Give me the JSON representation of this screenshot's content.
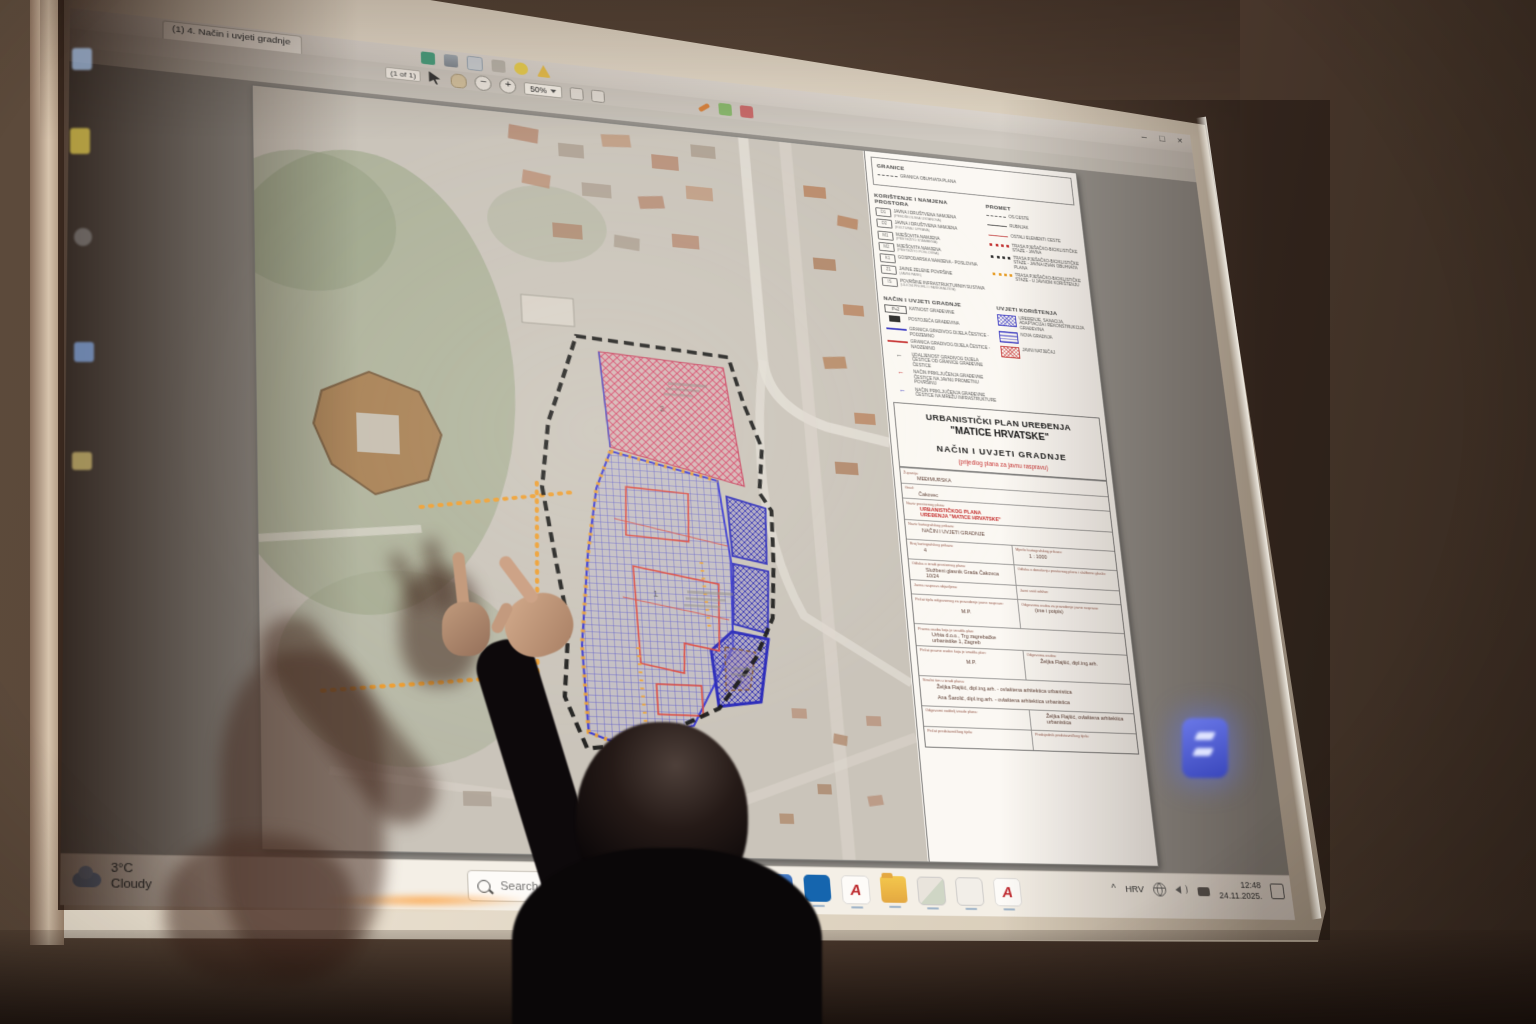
{
  "app": {
    "tab_title": "(1) 4. Način i uvjeti gradnje",
    "page_indicator": "(1 of 1)",
    "zoom_level": "50%",
    "zoom_out_glyph": "−",
    "zoom_in_glyph": "+",
    "customize_label": "Customize",
    "window_controls": [
      {
        "name": "minimize-button",
        "glyph": "–"
      },
      {
        "name": "maximize-button",
        "glyph": "□"
      },
      {
        "name": "close-button",
        "glyph": "×"
      }
    ],
    "panel_tabs": [
      {
        "name": "tab-tools",
        "label": "Tools"
      },
      {
        "name": "tab-fill-sign",
        "label": "Fill & Sign"
      },
      {
        "name": "tab-comment",
        "label": "Comment"
      }
    ],
    "toolbar_icons_row1": [
      {
        "name": "save-icon"
      },
      {
        "name": "print-icon"
      },
      {
        "name": "email-icon"
      },
      {
        "name": "attach-icon"
      },
      {
        "name": "comment-bubble-icon"
      },
      {
        "name": "warning-icon"
      }
    ],
    "toolbar_icons_row2b": [
      {
        "name": "pen-icon"
      },
      {
        "name": "stamp-green-icon"
      },
      {
        "name": "stamp-red-icon"
      }
    ],
    "sidebar_icon_names": [
      "thumbnails-icon",
      "signature-icon",
      "bookmarks-icon",
      "layers-icon",
      "attachments-icon"
    ]
  },
  "document": {
    "legend": {
      "granice_header": "GRANICE",
      "granice_item": "GRANICA OBUHVATA PLANA",
      "namjena_header": "KORIŠTENJE I NAMJENA PROSTORA",
      "namjena_items": [
        {
          "code": "D1",
          "label": "JAVNA I DRUŠTVENA NAMJENA",
          "sub": "(PREDŠKOLSKA USTANOVA)"
        },
        {
          "code": "D2",
          "label": "JAVNA I DRUŠTVENA NAMJENA",
          "sub": "(KULTURA I UPRAVA)"
        },
        {
          "code": "M1",
          "label": "MJEŠOVITA NAMJENA",
          "sub": "(PRETEŽITO STAMBENA)"
        },
        {
          "code": "M2",
          "label": "MJEŠOVITA NAMJENA",
          "sub": "(PRETEŽITO POSLOVNA)"
        },
        {
          "code": "K1",
          "label": "GOSPODARSKA NAMJENA - POSLOVNA",
          "sub": ""
        },
        {
          "code": "Z1",
          "label": "JAVNE ZELENE POVRŠINE",
          "sub": "(JAVNI PARK)"
        },
        {
          "code": "IS",
          "label": "POVRŠINE INFRASTRUKTURNIH SUSTAVA",
          "sub": "(ULIČNI PROFILI I PARKIRALIŠTA)"
        }
      ],
      "promet_header": "PROMET",
      "promet_items": [
        {
          "sym": "axis",
          "tag": "",
          "label": "OS CESTE",
          "lcls": ""
        },
        {
          "sym": "solid",
          "tag": "",
          "label": "RUBNJAK",
          "lcls": ""
        },
        {
          "sym": "thinred",
          "tag": "",
          "label": "OSTALI ELEMENTI CESTE",
          "lcls": ""
        },
        {
          "sym": "dots-red",
          "tag": "",
          "label": "TRASA PJEŠAČKO-BICIKLISTIČKE STAZE - JAVNA",
          "lcls": ""
        },
        {
          "sym": "dots-black",
          "tag": "",
          "label": "TRASA PJEŠAČKO-BICIKLISTIČKE STAZE - JAVNA IZVAN OBUHVATA PLANA",
          "lcls": ""
        },
        {
          "sym": "dots-orange",
          "tag": "",
          "label": "TRASA PJEŠAČKO-BICIKLISTIČKE STAZE - U JAVNOM KORIŠTENJU",
          "lcls": ""
        }
      ],
      "gradnja_header": "NAČIN I UVJETI GRADNJE",
      "gradnja_items": [
        {
          "sym": "tagbox",
          "tag": "P+2",
          "label": "KATNOST GRAĐEVINE",
          "lcls": ""
        },
        {
          "sym": "blackbox",
          "tag": "",
          "label": "POSTOJEĆA GRAĐEVINA",
          "lcls": ""
        },
        {
          "sym": "blueline",
          "tag": "",
          "label": "GRANICA GRADIVOG DIJELA ČESTICE - PODZEMNO",
          "lcls": ""
        },
        {
          "sym": "redline2",
          "tag": "",
          "label": "GRANICA GRADIVOG DIJELA ČESTICE - NADZEMNO",
          "lcls": ""
        },
        {
          "sym": "arr gray",
          "tag": "←",
          "label": "UDALJENOST GRADIVOG DIJELA ČESTICE OD GRANICE GRAĐEVNE ČESTICE",
          "lcls": ""
        },
        {
          "sym": "arr red",
          "tag": "←",
          "label": "NAČIN PRIKLJUČENJA GRAĐEVNE ČESTICE NA JAVNU PROMETNU POVRŠINU",
          "lcls": ""
        },
        {
          "sym": "arr blue",
          "tag": "←",
          "label": "NAČIN PRIKLJUČENJA GRAĐEVNE ČESTICE NA MREŽU INFRASTRUKTURE",
          "lcls": ""
        }
      ],
      "uvjeti_header": "UVJETI KORIŠTENJA",
      "uvjeti_items": [
        {
          "sym": "crossblue",
          "label": "UREĐENJE, SANACIJA, ADAPTACIJA I REKONSTRUKCIJA GRAĐEVINA"
        },
        {
          "sym": "linesblue",
          "label": "NOVA GRADNJA"
        },
        {
          "sym": "crossred",
          "label": "JAVNI NATJEČAJ"
        }
      ]
    },
    "title_block": {
      "line1": "URBANISTIČKI PLAN UREĐENJA",
      "line2": "\"MATICE HRVATSKE\"",
      "line3": "NAČIN I UVJETI GRADNJE",
      "line4": "(prijedlog plana za javnu raspravu)"
    },
    "info_table": {
      "rows": [
        {
          "l": "Županija:",
          "v": "MEĐIMURSKA",
          "cls": "",
          "vcls": ""
        },
        {
          "l": "Grad:",
          "v": "Čakovec",
          "cls": "",
          "vcls": ""
        },
        {
          "l": "Naziv prostornog plana:",
          "v": "URBANISTIČKOG PLANA UREĐENJA \"MATICE HRVATSKE\"",
          "cls": "r-med",
          "vcls": "red"
        },
        {
          "l": "Naziv kartografskog prikaza:",
          "v": "NAČIN I UVJETI GRADNJE",
          "cls": "r-med",
          "vcls": ""
        },
        {
          "l": "Broj kartografskog prikaza:",
          "v": "4",
          "l2": "Mjerilo kartografskog prikaza:",
          "v2": "1 : 1000",
          "cls": "r-med",
          "vcls": ""
        },
        {
          "l": "Odluka o izradi prostornog plana:",
          "v": "Službeni glasnik Grada Čakovca 10/24",
          "l2": "Odluka o donošenju prostornog plana i službeno glasilo:",
          "v2": "",
          "cls": "r-med",
          "vcls": ""
        },
        {
          "l": "Javna rasprava objavljena:",
          "v": "",
          "l2": "Javni uvid održan:",
          "v2": "",
          "cls": "",
          "vcls": ""
        },
        {
          "l": "Pečat tijela odgovornog za provođenje javne rasprave:",
          "v": "M.P.",
          "l2": "Odgovorna osoba za provođenje javne rasprave:",
          "v2": "(ime i potpis)",
          "cls": "r-tall",
          "vcls": "ctr"
        },
        {
          "l": "Pravna osoba koja je izradila plan:",
          "v": "Urbia d.o.o., Trg zagrebačke urbanistike 1, Zagreb",
          "cls": "r-med",
          "vcls": ""
        },
        {
          "l": "Pečat pravne osobe koja je izradila plan:",
          "v": "M.P.",
          "l2": "Odgovorna osoba:",
          "v2": "Željka Flajšić, dipl.ing.arh.",
          "cls": "r-tall",
          "vcls": "ctr"
        },
        {
          "l": "Stručni tim u izradi plana:",
          "v": "Željka Flajšić, dipl.ing.arh. - ovlaštena arhitektica urbanistica",
          "l2": "",
          "v2": "Ana Šarolić, dipl.ing.arh. - ovlaštena arhitektica urbanistica",
          "cls": "r-tall stackcol",
          "vcls": ""
        },
        {
          "l": "Odgovorni voditelj izrade plana:",
          "v": "",
          "l2": "",
          "v2": "Željka Flajšić, ovlaštena arhitektica urbanistica",
          "cls": "r-med",
          "vcls": ""
        },
        {
          "l": "Pečat predstavničkog tijela:",
          "v": "",
          "l2": "Predsjednik predstavničkog tijela:",
          "v2": "",
          "cls": "r-med",
          "vcls": ""
        }
      ]
    }
  },
  "map": {
    "labels": [
      "2",
      "1",
      "3"
    ],
    "colors": {
      "boundary": "#141414",
      "red_zone_hatch": "#dd4f72",
      "blue_zone_grid": "#6060d8",
      "purple_zone_hatch": "#3c3cc0",
      "orange_route": "#f3a02a",
      "red_outline": "#e84438",
      "blue_outline": "#3232d8"
    }
  },
  "taskbar": {
    "weather_temp": "3°C",
    "weather_desc": "Cloudy",
    "search_placeholder": "Search",
    "app_icons": [
      {
        "name": "chrome-icon",
        "glyph": ""
      },
      {
        "name": "mail-icon",
        "glyph": ""
      },
      {
        "name": "outlook-icon",
        "glyph": ""
      },
      {
        "name": "autocad-icon",
        "glyph": "A"
      },
      {
        "name": "explorer-icon",
        "glyph": ""
      },
      {
        "name": "photos-icon",
        "glyph": ""
      },
      {
        "name": "snip-icon",
        "glyph": ""
      },
      {
        "name": "acrobat-icon",
        "glyph": "A"
      }
    ],
    "tray": {
      "expand": "^",
      "language": "HRV",
      "icon_names": [
        "network-icon",
        "volume-icon",
        "device-icon"
      ],
      "time": "12:48",
      "date": "24.11.2025."
    }
  }
}
